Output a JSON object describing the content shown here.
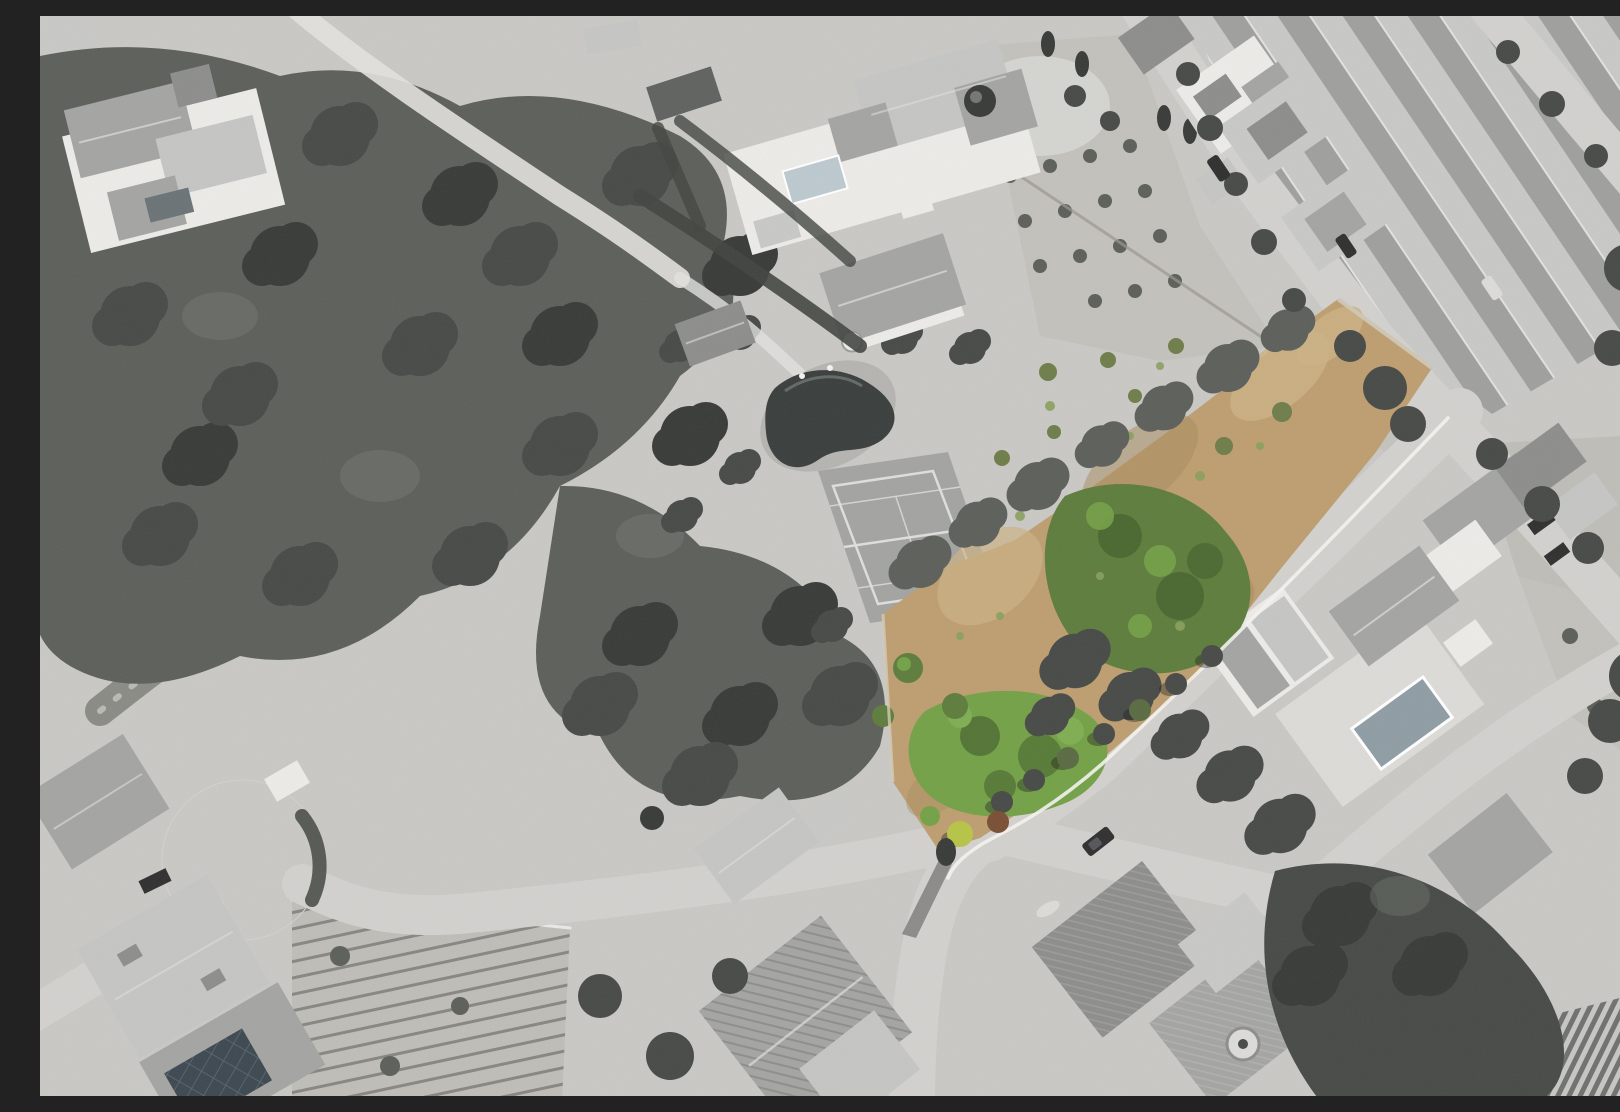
{
  "scene": {
    "type": "aerial-drone-photograph",
    "description": "Top-down aerial photograph of a Mediterranean residential neighbourhood rendered in grayscale, with one vacant elongated land plot highlighted in natural colour (dry tan grass with green trees and shrubs). Around it: a pine forest and dry ravine to the west, a villa with swimming pool and a tennis court in the centre, rows of terraced townhouses along diagonal streets to the north-east, villas with pools to the east, a cul-de-sac, garden terraces, a solar-panel roof and a greenhouse to the south.",
    "style": "grayscale photo with colour-highlighted parcel",
    "features": [
      "highlighted-vacant-plot",
      "pine-forest",
      "dry-ravine",
      "pond",
      "tennis-court",
      "villa-with-pool",
      "terraced-townhouse-rows",
      "streets",
      "cul-de-sac",
      "roadside-bush-row",
      "parked-cars",
      "garden-terraces",
      "solar-panel-roof",
      "greenhouse",
      "fountain",
      "orchards"
    ]
  },
  "palette": {
    "ground": "#c9c8c5",
    "ground-light": "#dcdbd8",
    "road": "#d2d1ce",
    "road-bright": "#e2e1de",
    "curb": "#f4f3f0",
    "tree-dark": "#474a46",
    "tree-mid": "#5c5f5a",
    "tree-deep": "#383b37",
    "tree-pale": "#74776f",
    "hedge": "#424540",
    "roof-light": "#c5c6c4",
    "roof-mid": "#a4a5a3",
    "roof-dark": "#8d8e8c",
    "wall-white": "#ecebe8",
    "row-wall": "#c8c9c7",
    "row-roof": "#9fa09e",
    "orchard": "#c3c1bb",
    "field": "#bfbdb7",
    "pool-blue": "#bcc9cf",
    "pool-gray": "#8f9da4",
    "water": "#3a3e3c",
    "pond-rim": "#b5b4b0",
    "court": "#a3a4a2",
    "court-line": "#dededc",
    "plot-tan": "#bd9e70",
    "plot-tan-light": "#ccb284",
    "plot-tan-dark": "#a8895c",
    "plot-green": "#5d7d3c",
    "plot-green-bright": "#74a147",
    "plot-green-deep": "#46632d",
    "olive": "#6f7d4a",
    "tuft": "#8aa05c",
    "bush-yellow": "#b7c447",
    "bush-rust": "#7a4f35",
    "car-dark": "#2f302f",
    "car-gray": "#dcdbd8",
    "solar": "#3e4850",
    "shadow": "rgba(25,27,25,0.38)"
  }
}
